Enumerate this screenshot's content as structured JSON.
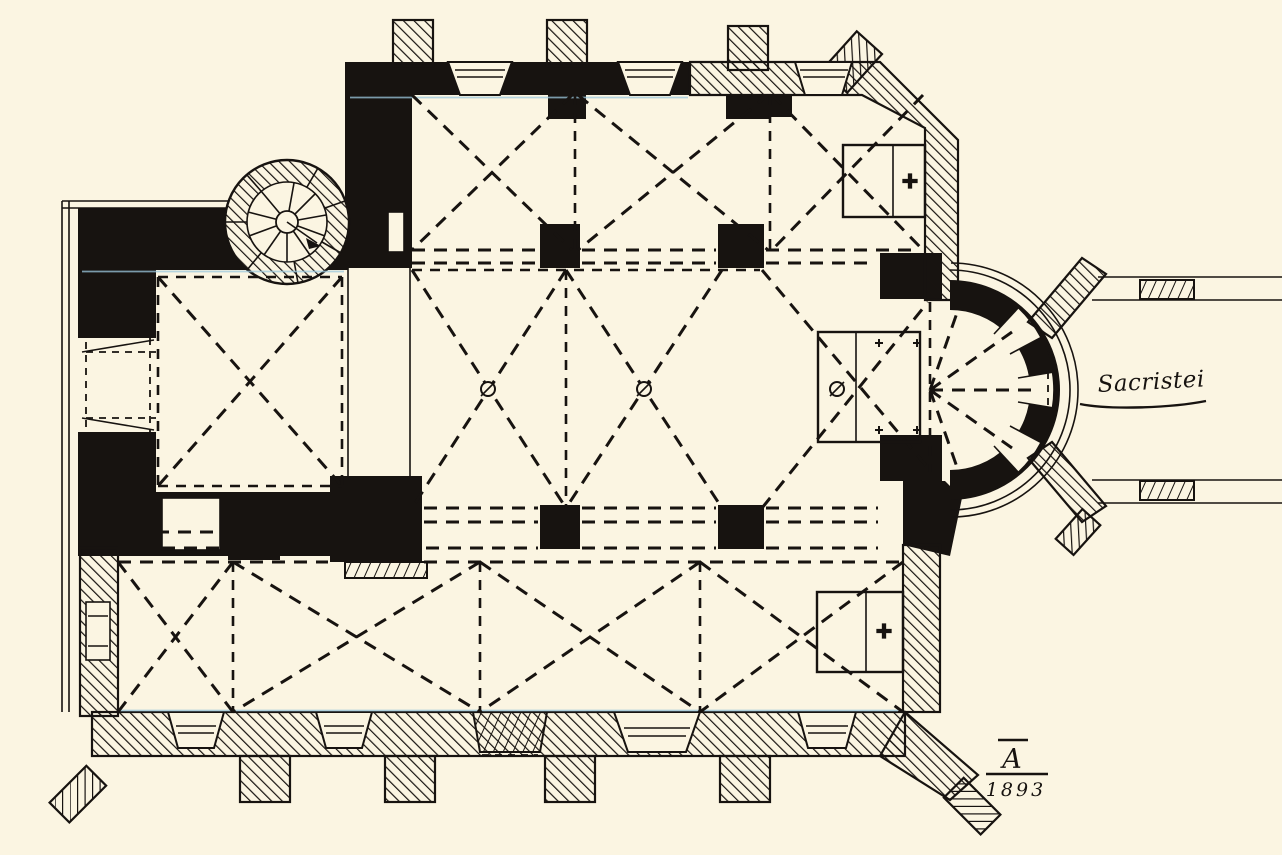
{
  "plan": {
    "labels": {
      "sacristy": "Sacristei"
    },
    "signature": {
      "monogram": "A",
      "year": "1893"
    },
    "icons": {
      "consecration_cross_icon": "✚",
      "altar_corner_cross_icon": "+",
      "stair_direction_arrow_icon": "→"
    },
    "colors": {
      "paper": "#fbf5e2",
      "ink": "#171310",
      "scan_fringe": "#9cc8de"
    }
  }
}
